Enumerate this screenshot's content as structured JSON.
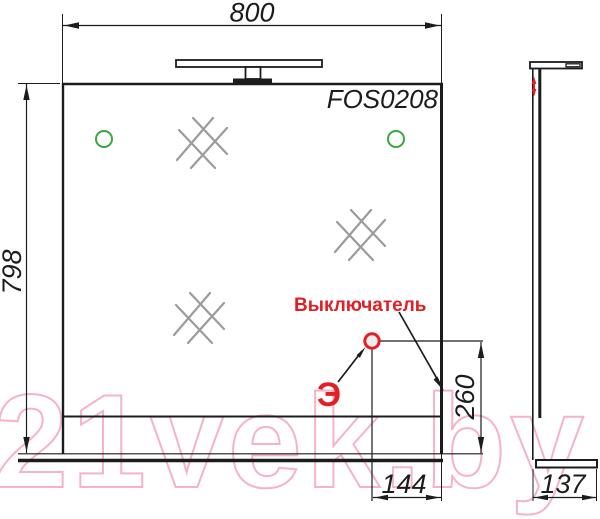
{
  "drawing": {
    "model_label": "FOS0208",
    "dims": {
      "width": "800",
      "height": "798",
      "switch_height": "260",
      "switch_offset": "144",
      "depth": "137"
    },
    "annotations": {
      "switch_label": "Выключатель",
      "electric_mark": "Э"
    },
    "watermark_text": "21vek.by",
    "colors": {
      "line": "#1c1c1c",
      "accent_red": "#e31e24",
      "accent_green": "#36a93c",
      "hatch_gray": "#9b9b9b",
      "watermark_pink": "#f5b3c5"
    }
  }
}
